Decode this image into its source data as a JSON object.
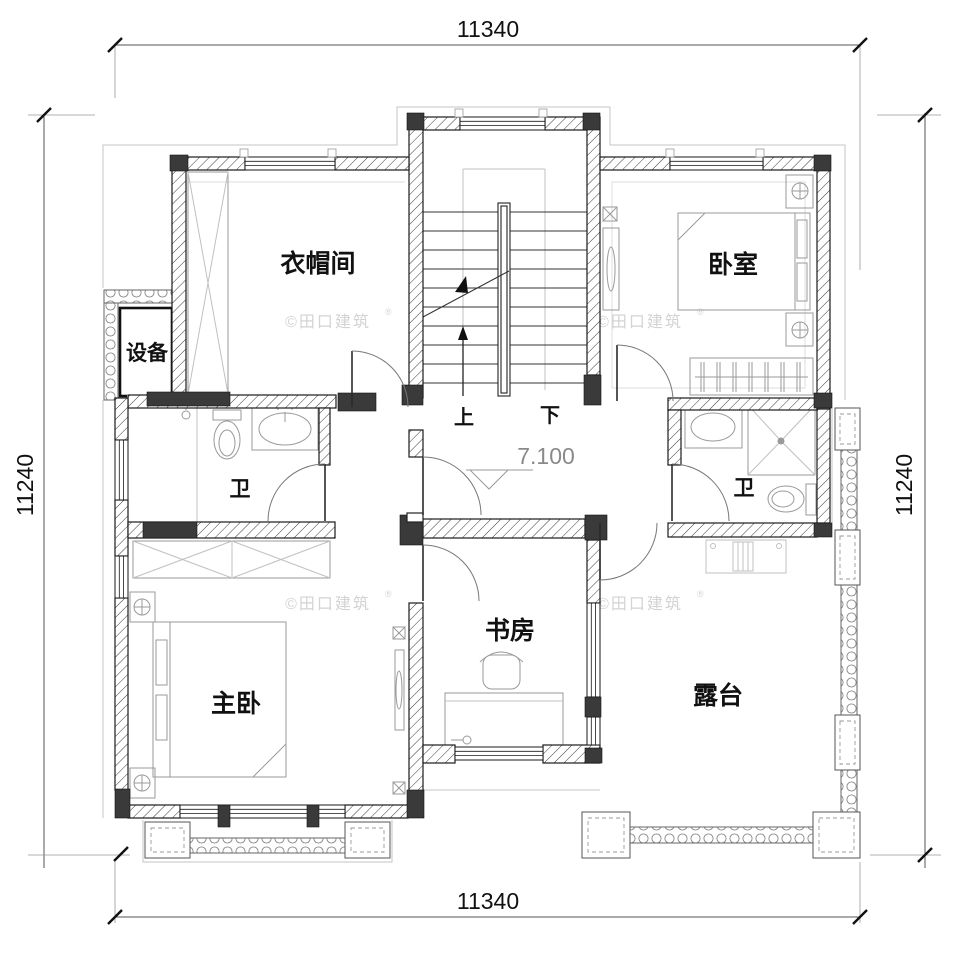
{
  "dimensions": {
    "top": "11340",
    "bottom": "11340",
    "left": "11240",
    "right": "11240"
  },
  "rooms": {
    "cloakroom": "衣帽间",
    "bedroom": "卧室",
    "equipment": "设备",
    "bath_left": "卫",
    "bath_right": "卫",
    "master_bedroom": "主卧",
    "study": "书房",
    "terrace": "露台"
  },
  "stairs": {
    "up_label": "上",
    "down_label": "下"
  },
  "elevation": {
    "value": "7.100"
  },
  "watermark": {
    "text": "©田口建筑",
    "reg": "®"
  },
  "colors": {
    "line": "#1a1a1a",
    "column_fill": "#3a3a3a",
    "furniture": "#9a9a9a",
    "eave": "#c6c6c6",
    "elevation_gray": "#8a8a8a",
    "watermark": "#d3d3d3"
  }
}
